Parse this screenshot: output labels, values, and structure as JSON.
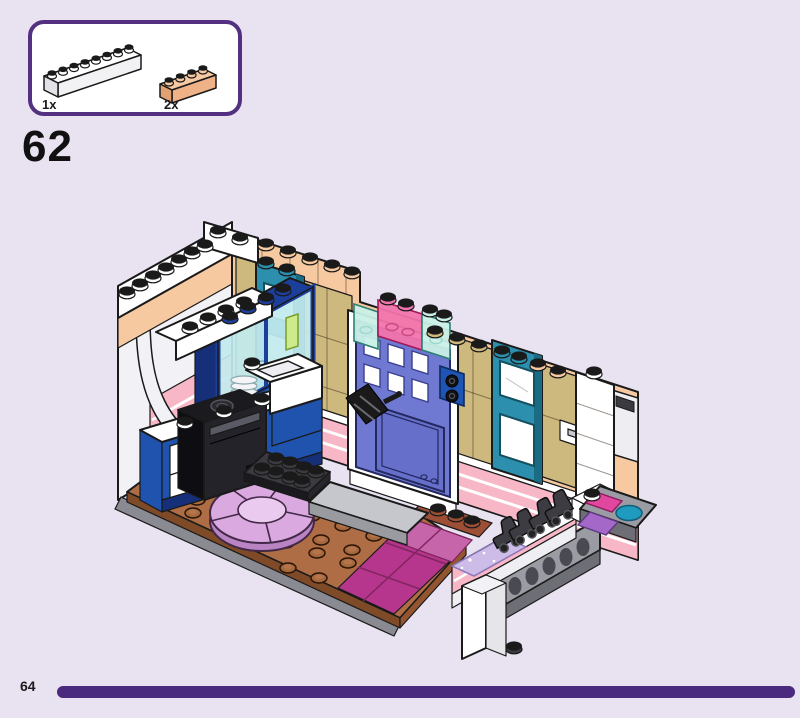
{
  "page": {
    "step_number": "62",
    "page_number": "64",
    "background_color": "#E9E2F1",
    "footer_bar_color": "#4A2A7E"
  },
  "parts_callout": {
    "border_color": "#533180",
    "background": "#FFFFFF",
    "parts": [
      {
        "quantity": "1x",
        "part_name": "brick-1x8-white",
        "color": "#FFFFFF"
      },
      {
        "quantity": "2x",
        "part_name": "brick-1x4-light-nougat",
        "color": "#F6C9A2"
      }
    ]
  },
  "illustration": {
    "type": "lego-assembly-step-diagram",
    "scene": "isometric room interior: kitchen with arch and cabinets, front door with lamp, two windows, studded floor with round rug, street bench with roller skates and lattice fence",
    "palette": {
      "wall_peach": "#F7C9A0",
      "wall_tan": "#CDB97E",
      "window_teal": "#2B8FAD",
      "door_blue": "#7079D2",
      "accent_pink": "#F8B7C7",
      "cabinet_blue": "#2053AE",
      "floor_brown": "#AE6D44",
      "rug_lavender": "#D9A9E0",
      "tile_magenta": "#B5368C",
      "base_gray": "#9B9BA3",
      "trans_pink": "#F274AC",
      "trans_aqua": "#C9F0E7"
    }
  }
}
